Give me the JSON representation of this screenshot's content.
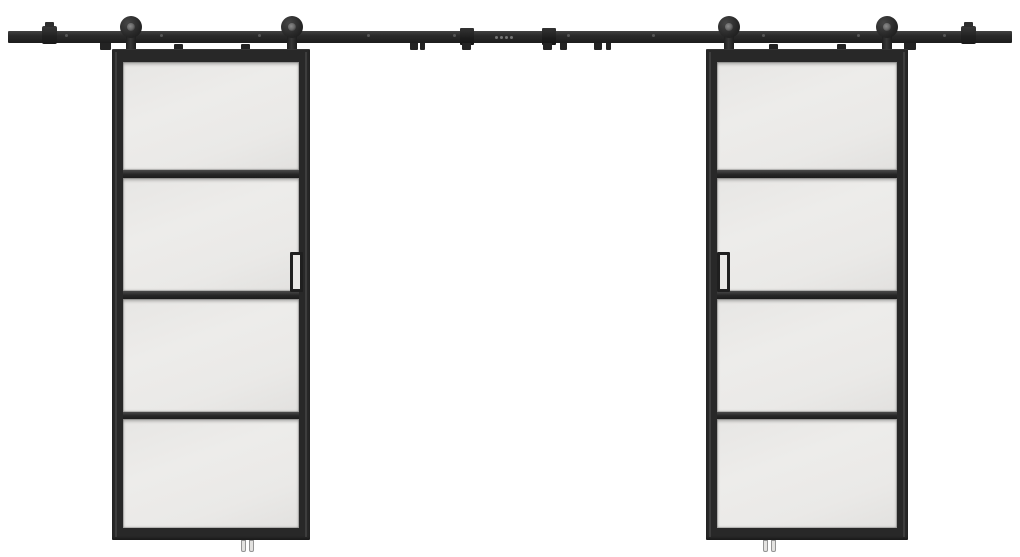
{
  "meta": {
    "scene": "Product photo: double sliding barn doors with black frames, frosted glass lites and top-mount rolling hardware kit",
    "background_color": "#ffffff"
  },
  "colors": {
    "hardware": "#262626",
    "hardware_dark": "#1c1c1c",
    "hardware_highlight": "#454545",
    "frame": "#282828",
    "glass": "#eae9e7",
    "glass_edge": "#e2e1df",
    "hub": "#6b6b6b",
    "guide_pin": "#e3e2e0",
    "background": "#ffffff"
  },
  "hardware": {
    "rail": {
      "end_stops": 2,
      "connector_brackets": 2,
      "mounting_screws": 10,
      "center_marks": 4
    },
    "rollers": {
      "count": 4,
      "type": "top-mount strap roller with wheel"
    },
    "floor_guides": {
      "count": 2,
      "pins_per_guide": 2
    }
  },
  "doors": {
    "count": 2,
    "style": "black steel frame with frosted glass",
    "lites_per_door": 4,
    "handles_per_door": 1
  }
}
